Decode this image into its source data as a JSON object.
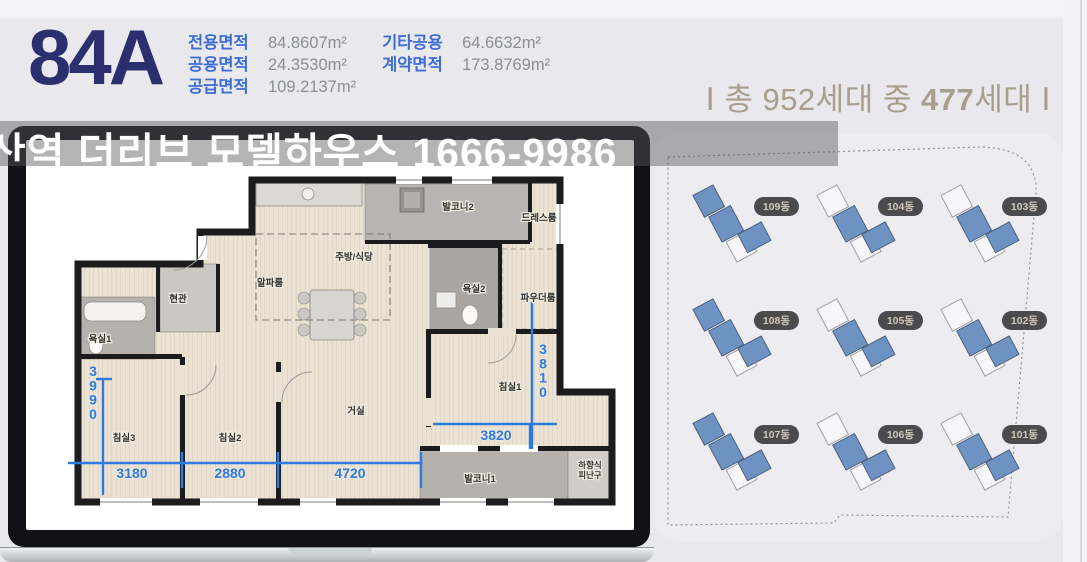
{
  "header": {
    "unit_code": "84A",
    "area_table": {
      "col1": [
        {
          "label": "전용면적",
          "value": "84.8607m²"
        },
        {
          "label": "공용면적",
          "value": "24.3530m²"
        },
        {
          "label": "공급면적",
          "value": "109.2137m²"
        }
      ],
      "col2": [
        {
          "label": "기타공용",
          "value": "64.6632m²"
        },
        {
          "label": "계약면적",
          "value": "173.8769m²"
        }
      ]
    },
    "households": {
      "prefix": "Ⅰ 총 952세대 중 ",
      "highlight": "477",
      "suffix": "세대 Ⅰ"
    }
  },
  "banner": {
    "text": "산역 더리브 모델하우스 1666-9986"
  },
  "floorplan": {
    "rooms": [
      {
        "name": "현관",
        "x": 118,
        "y": 150
      },
      {
        "name": "알파룸",
        "x": 210,
        "y": 134
      },
      {
        "name": "주방/식당",
        "x": 294,
        "y": 108
      },
      {
        "name": "발코니2",
        "x": 398,
        "y": 58
      },
      {
        "name": "드레스룸",
        "x": 479,
        "y": 69
      },
      {
        "name": "욕실2",
        "x": 414,
        "y": 140
      },
      {
        "name": "파우더룸",
        "x": 478,
        "y": 149
      },
      {
        "name": "욕실1",
        "x": 40,
        "y": 190
      },
      {
        "name": "침실3",
        "x": 64,
        "y": 289
      },
      {
        "name": "침실2",
        "x": 170,
        "y": 289
      },
      {
        "name": "거실",
        "x": 296,
        "y": 262
      },
      {
        "name": "침실1",
        "x": 450,
        "y": 238
      },
      {
        "name": "발코니1",
        "x": 420,
        "y": 330
      },
      {
        "name": "하향식\n피난구",
        "x": 530,
        "y": 316,
        "small": true
      }
    ],
    "dimensions": [
      {
        "value": "3990",
        "x": 33,
        "y": 224,
        "orientation": "vertical"
      },
      {
        "value": "3180",
        "x": 72,
        "y": 326,
        "orientation": "horizontal"
      },
      {
        "value": "2880",
        "x": 170,
        "y": 326,
        "orientation": "horizontal"
      },
      {
        "value": "4720",
        "x": 290,
        "y": 326,
        "orientation": "horizontal"
      },
      {
        "value": "3820",
        "x": 436,
        "y": 288,
        "orientation": "horizontal"
      },
      {
        "value": "3810",
        "x": 483,
        "y": 202,
        "orientation": "vertical"
      }
    ]
  },
  "siteplan": {
    "buildings": [
      {
        "label": "109동",
        "top_blue": true
      },
      {
        "label": "104동",
        "top_blue": false
      },
      {
        "label": "103동",
        "top_blue": false
      },
      {
        "label": "108동",
        "top_blue": true
      },
      {
        "label": "105동",
        "top_blue": false
      },
      {
        "label": "102동",
        "top_blue": false
      },
      {
        "label": "107동",
        "top_blue": true
      },
      {
        "label": "106동",
        "top_blue": false
      },
      {
        "label": "101동",
        "top_blue": false
      }
    ]
  },
  "colors": {
    "unit_code_navy": "#2b2f6e",
    "area_label_blue": "#3e6ed5",
    "area_value_gray": "#8a8e95",
    "households_taupe": "#a89e90",
    "dimension_blue": "#2d7ae0",
    "building_blue": "#6e93c2",
    "pill_dark": "#4b4b4e"
  }
}
